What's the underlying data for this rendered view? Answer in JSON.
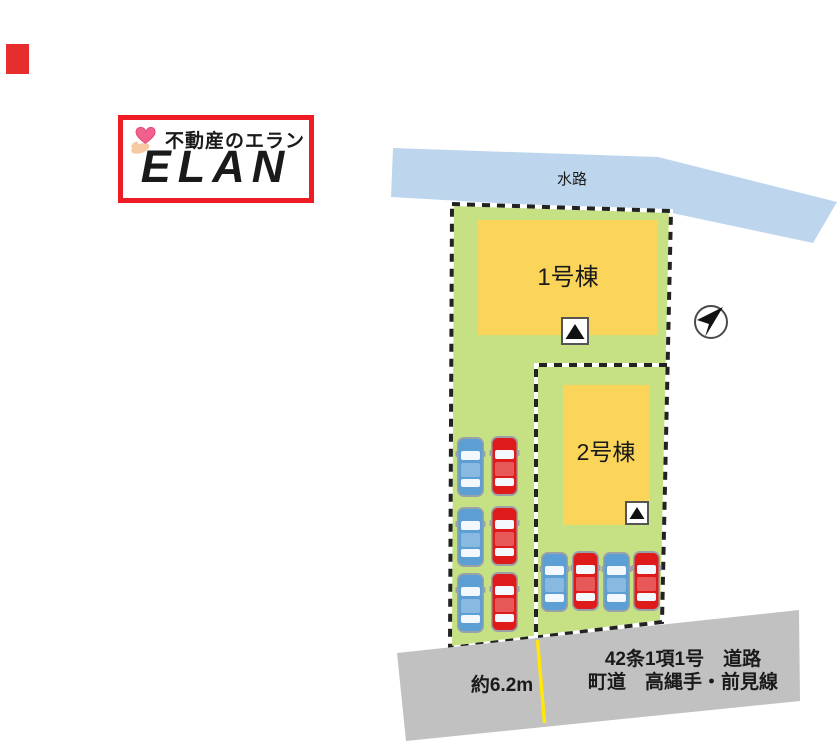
{
  "marker": {
    "color": "#e62e2e"
  },
  "logo": {
    "tagline": "不動産のエラン",
    "brand": "ELAN",
    "border_color": "#ee1c24"
  },
  "plan": {
    "water_label": "水路",
    "building1_label": "1号棟",
    "building2_label": "2号棟",
    "road_width_label": "約6.2m",
    "road_type_label": "42条1項1号　道路",
    "road_name_label": "町道　高縄手・前見線",
    "colors": {
      "water": "#bdd6ee",
      "plot": "#c6e183",
      "building": "#fbd45a",
      "road": "#c1c1c1",
      "center_line": "#ffe70a",
      "car_blue": "#5b9fd4",
      "car_red": "#de1a1a",
      "boundary": "#222222"
    }
  }
}
